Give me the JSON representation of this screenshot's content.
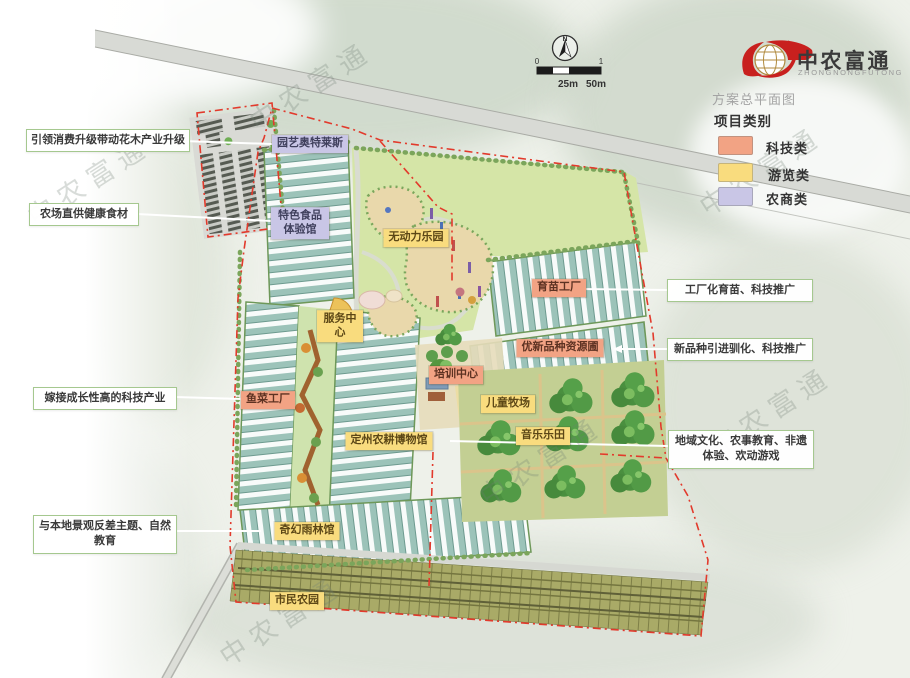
{
  "brand": {
    "name": "中农富通",
    "latin": "ZHONGNONGFUTONG",
    "subtitle": "方案总平面图"
  },
  "legend": {
    "title": "项目类别",
    "items": [
      {
        "label": "科技类",
        "color": "#f2a384"
      },
      {
        "label": "游览类",
        "color": "#f9dc7e"
      },
      {
        "label": "农商类",
        "color": "#c9c6e6"
      }
    ]
  },
  "compass": {
    "north_label": "N"
  },
  "scale_bar": {
    "tick_start": "0",
    "tick_end": "1",
    "label_mid": "25m",
    "label_end": "50m"
  },
  "plan_labels": [
    {
      "text": "园艺奥特莱斯",
      "category": "农商类"
    },
    {
      "text": "特色食品体验馆",
      "category": "农商类"
    },
    {
      "text": "无动力乐园",
      "category": "游览类"
    },
    {
      "text": "服务中心",
      "category": "游览类"
    },
    {
      "text": "育苗工厂",
      "category": "科技类"
    },
    {
      "text": "优新品种资源圃",
      "category": "科技类"
    },
    {
      "text": "培训中心",
      "category": "科技类"
    },
    {
      "text": "儿童牧场",
      "category": "游览类"
    },
    {
      "text": "鱼菜工厂",
      "category": "科技类"
    },
    {
      "text": "定州农耕博物馆",
      "category": "游览类"
    },
    {
      "text": "音乐乐田",
      "category": "游览类"
    },
    {
      "text": "奇幻雨林馆",
      "category": "游览类"
    },
    {
      "text": "市民农园",
      "category": "游览类"
    }
  ],
  "callouts": {
    "left": [
      "引领消费升级带动花木产业升级",
      "农场直供健康食材",
      "嫁接成长性高的科技产业",
      "与本地景观反差主题、自然教育"
    ],
    "right": [
      "工厂化育苗、科技推广",
      "新品种引进驯化、科技推广",
      "地域文化、农事教育、非遗体验、欢动游戏"
    ]
  },
  "watermark": {
    "text": "中农富通"
  },
  "colors": {
    "boundary_dash": "#e23a2c",
    "leader_line": "#ffffff",
    "road": "#d8dad5",
    "lawn": "#d5e5a7"
  }
}
